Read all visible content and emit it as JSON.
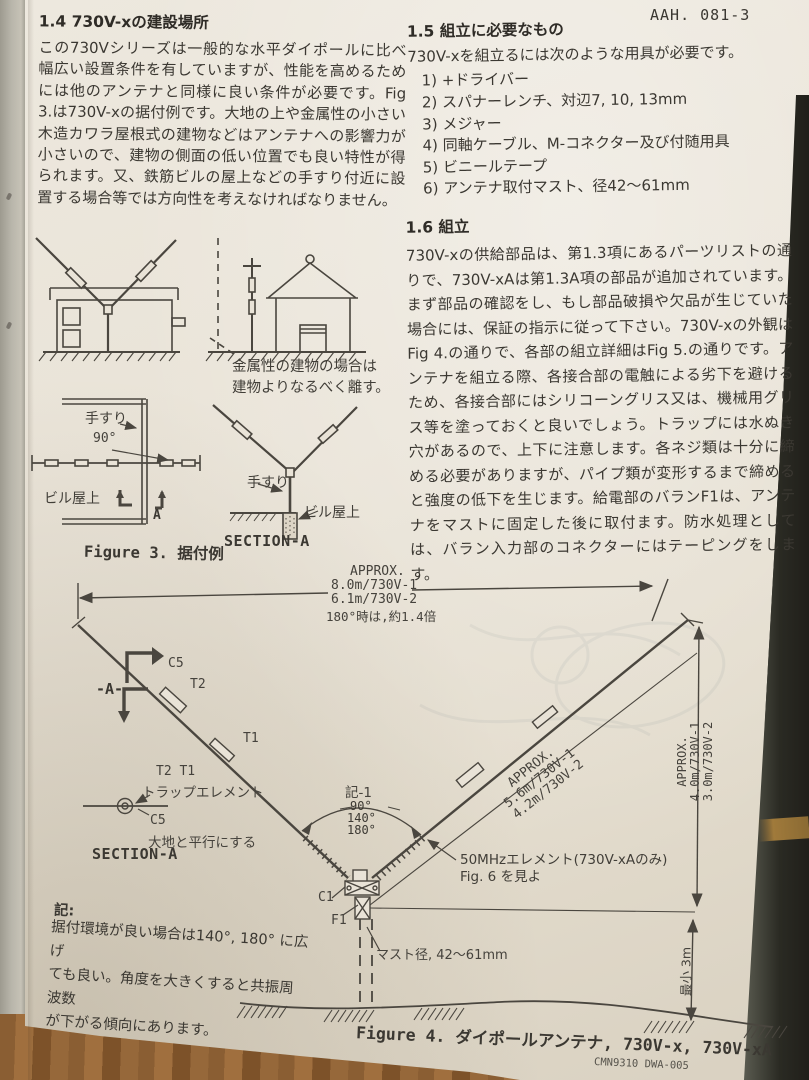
{
  "colors": {
    "paper": "#e9e3d7",
    "ink": "#3b3832",
    "drawing_line": "#4a463f",
    "table_dark": "#2a2a23",
    "wood": "#8a5e33"
  },
  "page_code": "AAH. 081-3",
  "left_column": {
    "s1_4": {
      "heading": "1.4 730V-xの建設場所",
      "body": "この730Vシリーズは一般的な水平ダイポールに比べ幅広い設置条件を有していますが、性能を高めるためには他のアンテナと同様に良い条件が必要です。Fig 3.は730V-xの据付例です。大地の上や金属性の小さい木造カワラ屋根式の建物などはアンテナへの影響力が小さいので、建物の側面の低い位置でも良い特性が得られます。又、鉄筋ビルの屋上などの手すり付近に設置する場合等では方向性を考えなければなりません。"
    }
  },
  "right_column": {
    "s1_5": {
      "heading": "1.5 組立に必要なもの",
      "intro": "730V-xを組立るには次のような用具が必要です。",
      "items": [
        "1)  +ドライバー",
        "2)  スパナーレンチ、対辺7, 10, 13mm",
        "3)  メジャー",
        "4)  同軸ケーブル、M-コネクター及び付随用具",
        "5)  ビニールテープ",
        "6)  アンテナ取付マスト、径42〜61mm"
      ]
    },
    "s1_6": {
      "heading": "1.6 組立",
      "body": "730V-xの供給部品は、第1.3項にあるパーツリストの通りで、730V-xAは第1.3A項の部品が追加されています。まず部品の確認をし、もし部品破損や欠品が生じていた場合には、保証の指示に従って下さい。730V-xの外観はFig 4.の通りで、各部の組立詳細はFig 5.の通りです。アンテナを組立る際、各接合部の電触による劣下を避けるため、各接合部にはシリコーングリス又は、機械用グリス等を塗っておくと良いでしょう。トラップには水ぬき穴があるので、上下に注意します。各ネジ類は十分に締める必要がありますが、パイプ類が変形するまで締めると強度の低下を生じます。給電部のバランF1は、アンテナをマストに固定した後に取付ます。防水処理としては、バラン入力部のコネクターにはテーピングをします。"
    }
  },
  "figure3": {
    "metal_note": "金属性の建物の場合は\n建物よりなるべく離す。",
    "handrail_plan": "手すり",
    "angle_90": "90°",
    "rooftop_plan": "ビル屋上",
    "section_arrow": "A",
    "handrail_section": "手すり",
    "rooftop_section": "ビル屋上",
    "section_title": "SECTION-A",
    "caption": "Figure 3. 据付例"
  },
  "figure4": {
    "dim_top": {
      "approx": "APPROX.",
      "v1": "8.0m/730V-1",
      "v2": "6.1m/730V-2",
      "note180": "180°時は,約1.4倍"
    },
    "marker_a": "-A-",
    "c5": "C5",
    "t2": "T2",
    "t1": "T1",
    "inset": {
      "traps": "T2  T1",
      "trap_name": "トラップエレメント",
      "c5": "C5",
      "parallel": "大地と平行にする",
      "title": "SECTION-A"
    },
    "angle_note": {
      "title": "記-1",
      "a1": "90°",
      "a2": "140°",
      "a3": "180°"
    },
    "dim_diag": "APPROX.\n5.6m/730V-1\n4.2m/730V-2",
    "element50": "50MHzエレメント(730V-xAのみ)\nFig. 6 を見よ",
    "c1": "C1",
    "f1": "F1",
    "mast": "マスト径, 42〜61mm",
    "dim_vert": "APPROX.\n4.0m/730V-1\n3.0m/730V-2",
    "dim_min": "最小 3m",
    "note": {
      "title": "記:",
      "body": "据付環境が良い場合は140°, 180° に広げ\nても良い。角度を大きくすると共振周波数\nが下がる傾向にあります。"
    },
    "caption": "Figure 4. ダイポールアンテナ, 730V-x, 730V-xA",
    "doc_code": "CMN9310    DWA-005"
  }
}
